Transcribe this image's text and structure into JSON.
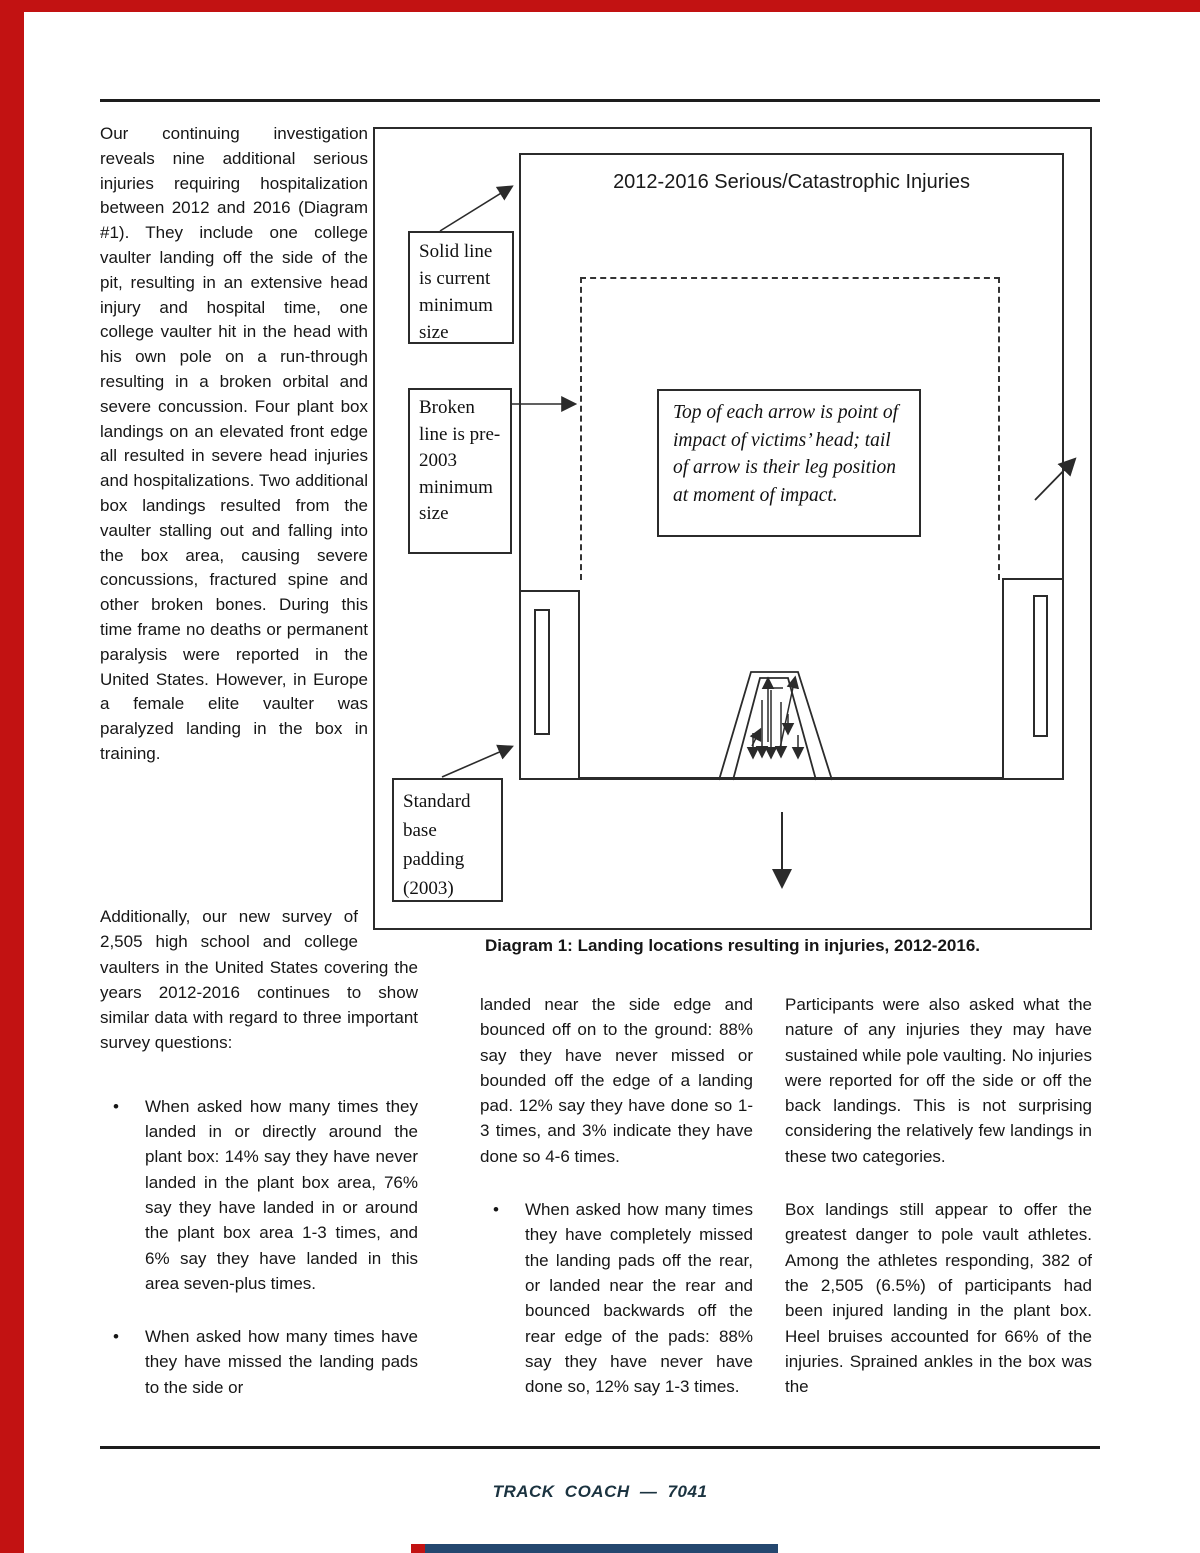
{
  "page": {
    "footer_text": "TRACK COACH — 7041",
    "accent_red": "#c21212",
    "strip_blue": "#24476f",
    "footer_navy": "#1b3340"
  },
  "article": {
    "bullet_char": "•",
    "left_paragraph": "Our continuing investigation reveals nine additional serious injuries requiring hospitalization between 2012 and 2016 (Diagram #1). They include one college vaulter landing off the side of the pit, resulting in an extensive head injury and hospital time, one college vaulter hit in the head with his own pole on a run-through resulting in a broken orbital and severe concussion. Four plant box landings on an elevated front edge all resulted in severe head injuries and hospitalizations. Two additional box landings resulted from the vaulter stalling out and falling into the box area, causing severe concussions, fractured spine and other broken bones. During this time frame no deaths or permanent paralysis were reported in the United States. However, in Europe a female elite vaulter was paralyzed landing in the box in training.",
    "caption": "Diagram 1: Landing locations resulting in injuries, 2012-2016.",
    "col1": {
      "intro": "Additionally, our new survey of 2,505 high school and college vaulters in the United States covering the years 2012-2016 continues to show similar data with regard to three important survey questions:",
      "bullet1": "When asked how many times they landed in or directly around the plant box: 14% say they have never landed in the plant box area, 76% say they have landed in or around the plant box area 1-3 times, and 6% say they have landed in this area seven-plus times.",
      "bullet2": "When asked how many times have they have missed the landing pads to the side or"
    },
    "col2": {
      "continuation": "landed near the side edge and bounced off on to the ground: 88% say they have never missed or bounded off the edge of a landing pad. 12% say they have done so 1-3 times, and 3% indicate they have done so 4-6 times.",
      "bullet": "When asked how many times they have completely missed the landing pads off the rear, or landed near the rear and bounced backwards off the rear edge of the pads: 88% say they have never have done so, 12% say 1-3 times."
    },
    "col3": {
      "p1": "Participants were also asked what the nature of any injuries they may have sustained while pole vaulting. No injuries were reported for off the side or off the back landings. This is not surprising considering the relatively few landings in these two categories.",
      "p2": "Box landings still appear to offer the greatest danger to pole vault athletes. Among the athletes responding, 382 of the 2,505 (6.5%) of participants had been injured landing in the plant box. Heel bruises accounted for 66% of the injuries. Sprained ankles in the box was the"
    }
  },
  "diagram": {
    "title": "2012-2016 Serious/Catastrophic Injuries",
    "solid_label": "Solid line is current minimum size",
    "broken_label": "Broken line is pre-2003 minimum size",
    "base_label": "Standard base padding (2003)",
    "note": "Top of each arrow is point of impact of victims’ head; tail of arrow is their leg position at moment of impact."
  }
}
